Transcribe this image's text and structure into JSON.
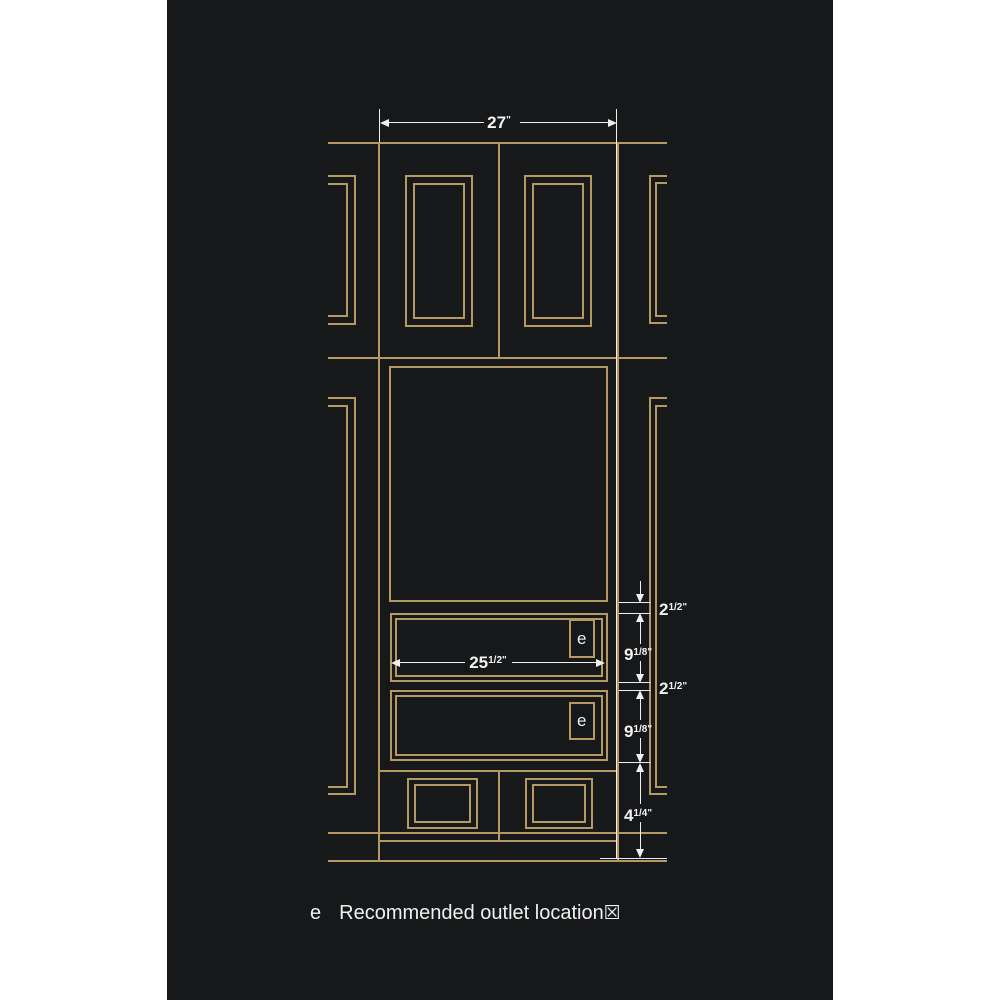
{
  "colors": {
    "background": "#17181a",
    "line_gold": "#b49a62",
    "line_white": "#efefef",
    "margin": "#ffffff"
  },
  "dims": {
    "top_width": {
      "whole": "27",
      "frac": "",
      "unit": "\""
    },
    "opening_width": {
      "whole": "25",
      "frac": "1/2",
      "unit": "\""
    },
    "right_chain": [
      {
        "whole": "2",
        "frac": "1/2",
        "unit": "\""
      },
      {
        "whole": "9",
        "frac": "1/8",
        "unit": "\""
      },
      {
        "whole": "2",
        "frac": "1/2",
        "unit": "\""
      },
      {
        "whole": "9",
        "frac": "1/8",
        "unit": "\""
      },
      {
        "whole": "4",
        "frac": "1/4",
        "unit": "\""
      }
    ]
  },
  "outlet": {
    "label": "e"
  },
  "legend": {
    "symbol": "e",
    "text": "Recommended outlet location",
    "missing_glyph": "☒"
  }
}
